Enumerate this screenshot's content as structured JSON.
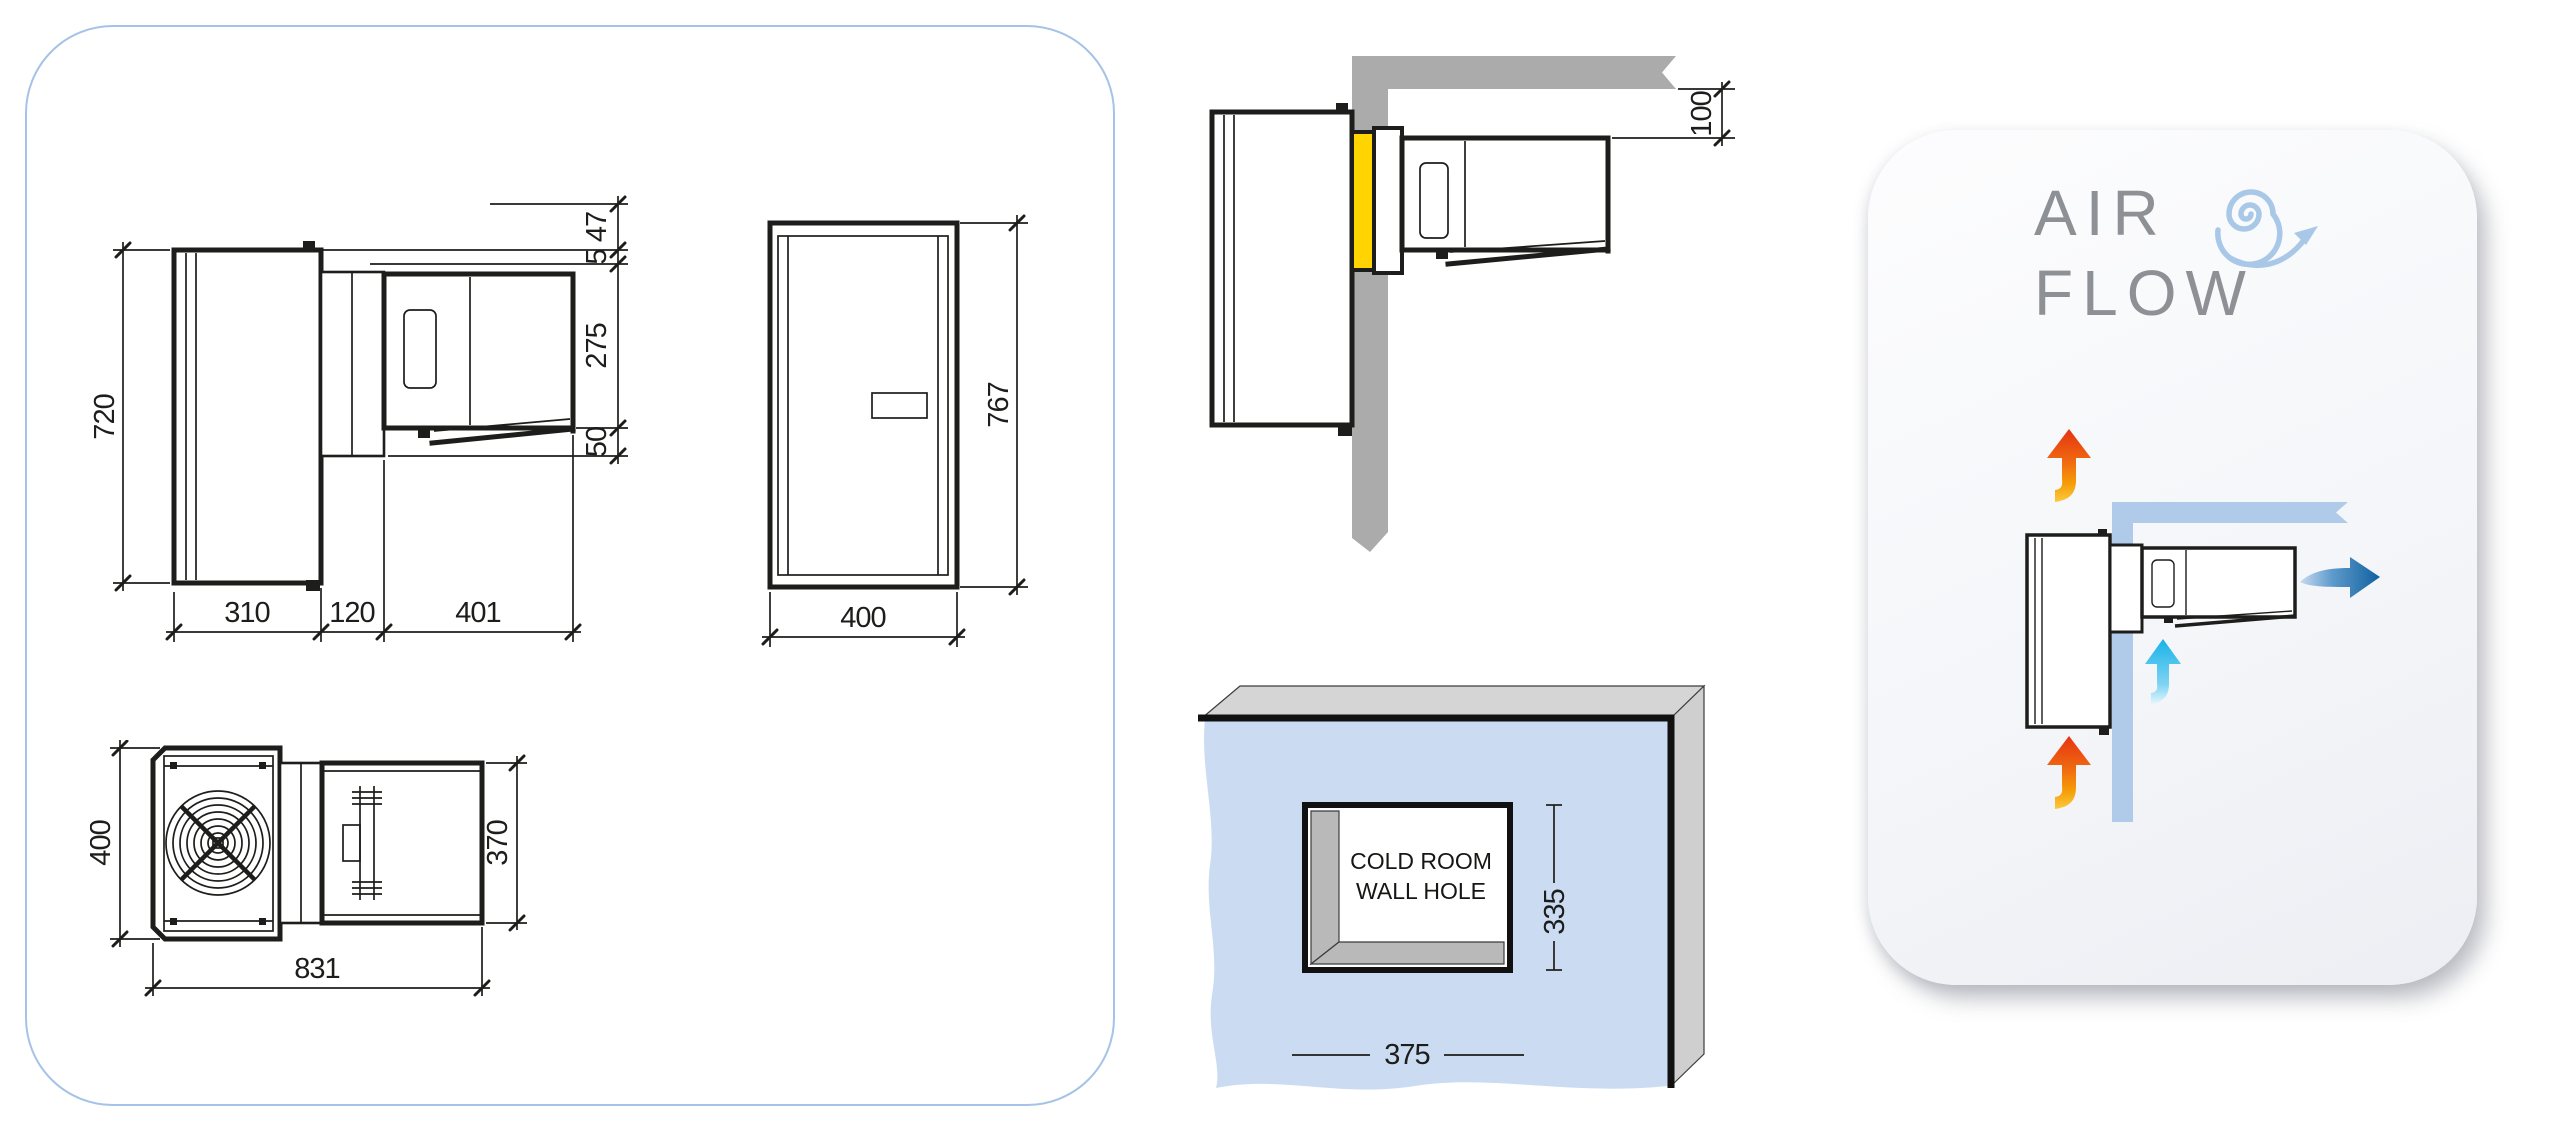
{
  "side_view": {
    "dim_height": "720",
    "dim_top_bracket": "47",
    "dim_gap": "5",
    "dim_condenser_height": "275",
    "dim_drop": "50",
    "dim_depth_inner": "310",
    "dim_depth_wall": "120",
    "dim_depth_outer": "401"
  },
  "front_view": {
    "dim_height": "767",
    "dim_width": "400"
  },
  "top_view": {
    "dim_width": "400",
    "dim_condenser_width": "370",
    "dim_length": "831"
  },
  "wall_mount_view": {
    "dim_ceiling_clearance": "100"
  },
  "wall_hole_view": {
    "label_line1": "COLD ROOM",
    "label_line2": "WALL HOLE",
    "dim_width": "375",
    "dim_height": "335"
  },
  "air_flow_panel": {
    "title_word1": "AIR",
    "title_word2": "FLOW"
  },
  "icons": {
    "swirl": "air-swirl-spiral-arrow",
    "hot_air": "hot-air-up-arrow",
    "cool_air": "cool-air-up-arrow",
    "cold_air_out": "cold-air-right-arrow",
    "fan": "fan-grille"
  },
  "colors": {
    "panel_border_blue": "#a5c3e6",
    "line_black": "#1d1d1b",
    "wall_gray": "#ababab",
    "gasket_yellow": "#ffd400",
    "coldroom_wall_blue": "#cbdcf2",
    "bevel_gray": "#b9b9b9",
    "airflow_band_blue": "#b0cbe9",
    "airflow_title_gray": "#8d9094",
    "arrow_hot_red": "#e63312",
    "arrow_hot_yellow": "#fcc93e",
    "arrow_cool_cyan": "#18b2e8",
    "arrow_cold_blue": "#11609f"
  }
}
